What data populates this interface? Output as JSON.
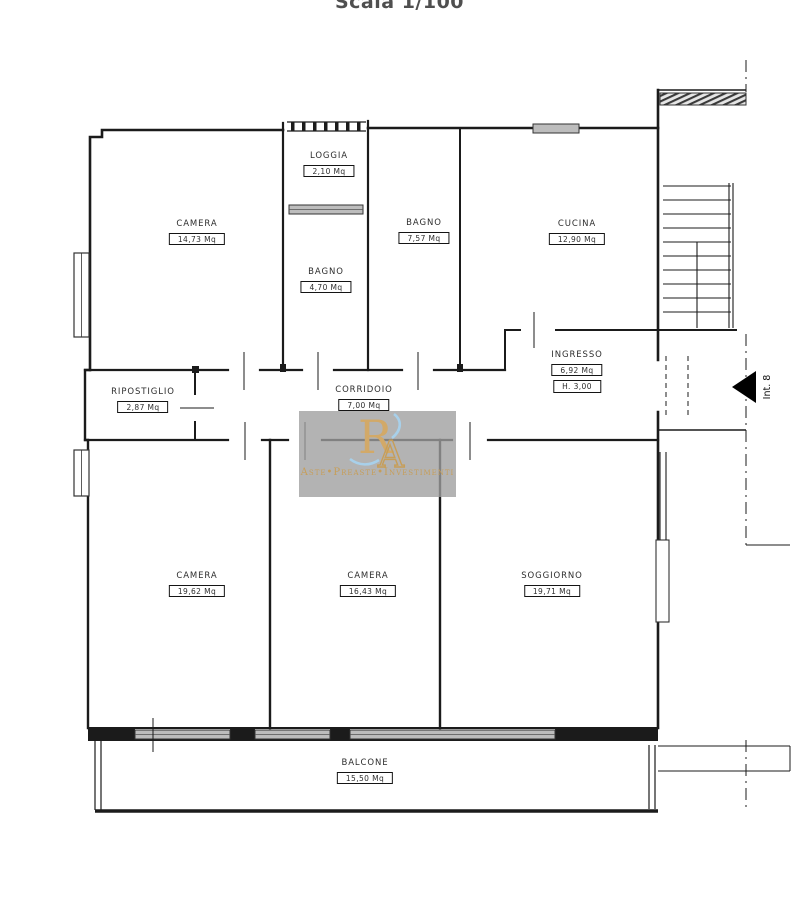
{
  "title": "Scala 1/100",
  "rooms": [
    {
      "name": "CAMERA",
      "area": "14,73 Mq"
    },
    {
      "name": "LOGGIA",
      "area": "2,10 Mq"
    },
    {
      "name": "BAGNO",
      "area": "4,70 Mq"
    },
    {
      "name": "BAGNO",
      "area": "7,57 Mq"
    },
    {
      "name": "CUCINA",
      "area": "12,90 Mq"
    },
    {
      "name": "INGRESSO",
      "area": "6,92 Mq",
      "height": "H. 3,00"
    },
    {
      "name": "RIPOSTIGLIO",
      "area": "2,87 Mq"
    },
    {
      "name": "CORRIDOIO",
      "area": "7,00 Mq"
    },
    {
      "name": "CAMERA",
      "area": "19,62 Mq"
    },
    {
      "name": "CAMERA",
      "area": "16,43 Mq"
    },
    {
      "name": "SOGGIORNO",
      "area": "19,71 Mq"
    },
    {
      "name": "BALCONE",
      "area": "15,50 Mq"
    }
  ],
  "entrance": {
    "label": "Int. 8"
  },
  "watermark": {
    "monogram": {
      "r": "R",
      "a": "A"
    },
    "text": "Aste•Preaste•Investimenti",
    "colors": {
      "gold": "#c79e58",
      "blue": "#a8d0ea",
      "background": "#9e9e9e"
    }
  },
  "colors": {
    "wall": "#1b1b1b",
    "window_fill": "#bdbdbd",
    "background": "#ffffff"
  }
}
